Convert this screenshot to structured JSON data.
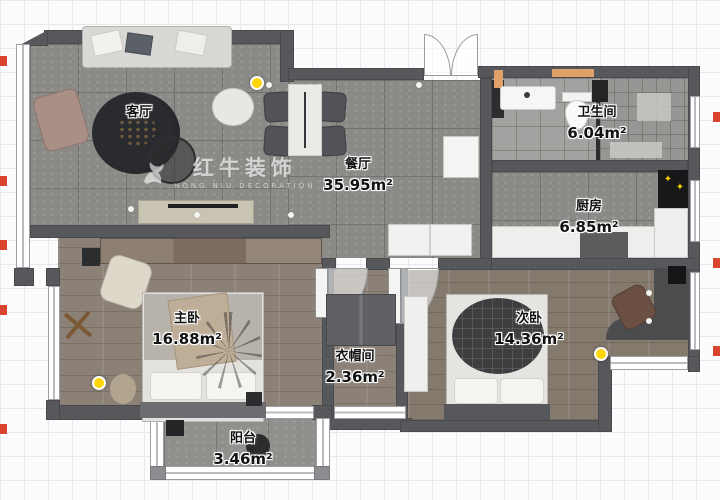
{
  "plan_title": "apartment-floor-plan",
  "watermark": {
    "brand": "红牛装饰",
    "subtitle": "HONG NIU DECORATION"
  },
  "rooms": [
    {
      "id": "living",
      "name": "客厅",
      "area": ""
    },
    {
      "id": "dining",
      "name": "餐厅",
      "area": "35.95m²"
    },
    {
      "id": "bathroom",
      "name": "卫生间",
      "area": "6.04m²"
    },
    {
      "id": "kitchen",
      "name": "厨房",
      "area": "6.85m²"
    },
    {
      "id": "master",
      "name": "主卧",
      "area": "16.88m²"
    },
    {
      "id": "cloak",
      "name": "衣帽间",
      "area": "2.36m²"
    },
    {
      "id": "second",
      "name": "次卧",
      "area": "14.36m²"
    },
    {
      "id": "balcony",
      "name": "阳台",
      "area": "3.46m²"
    }
  ],
  "colors": {
    "wall": "#56585b",
    "light_marker": "#ffd60a",
    "ruler_tick": "#d9442f",
    "door_threshold": "#e0a069"
  }
}
